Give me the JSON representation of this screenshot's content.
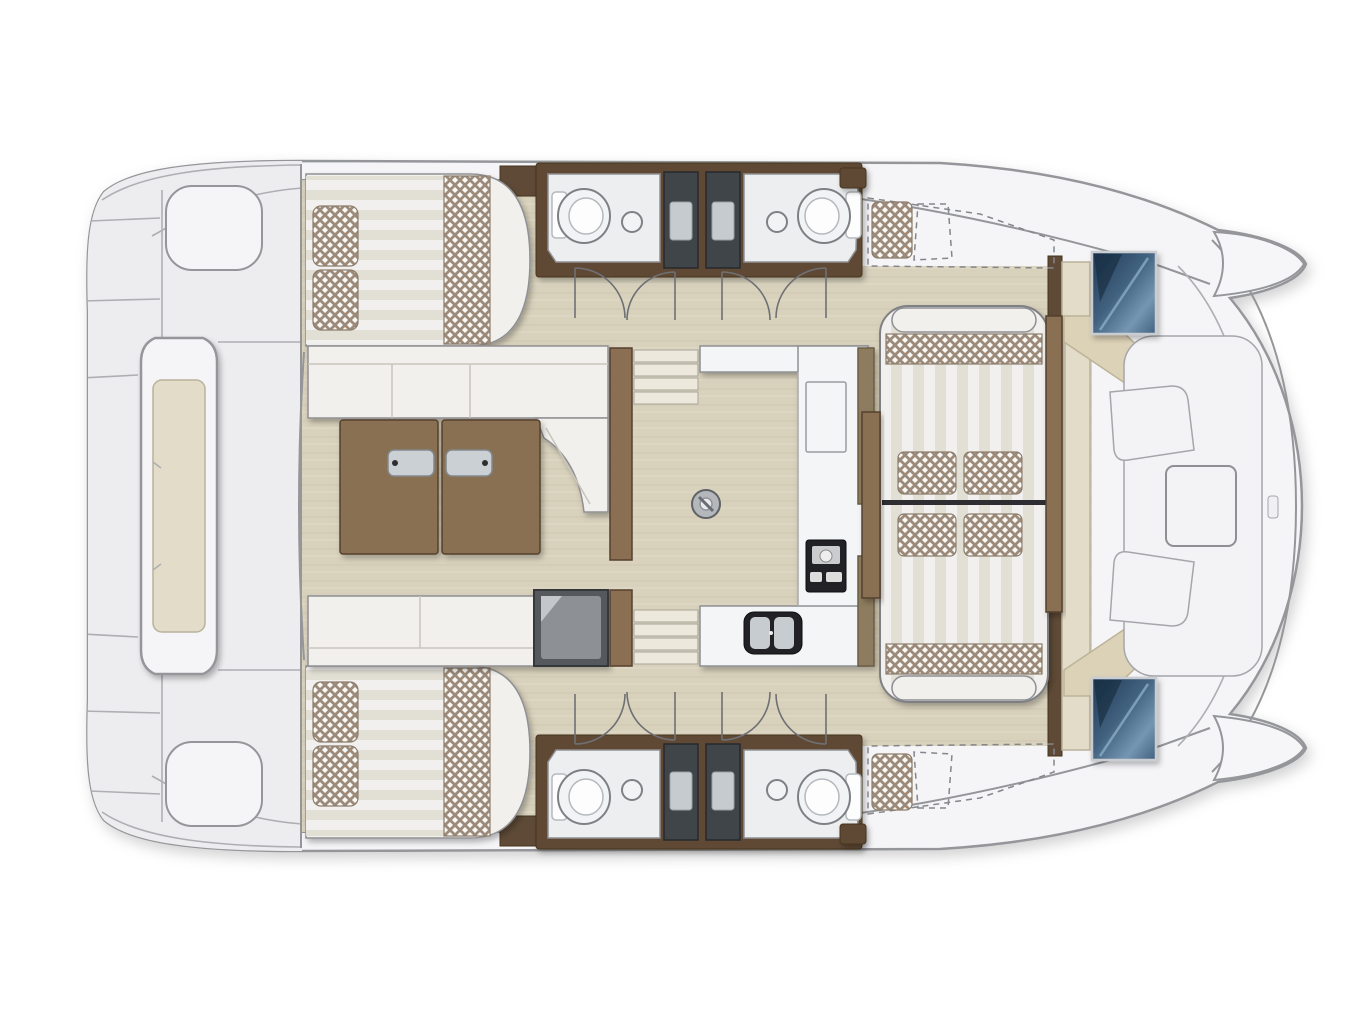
{
  "page": {
    "title": "Catamaran interior layout plan",
    "background": "#ffffff"
  },
  "plan": {
    "type": "catamaran-interior-floor-plan",
    "view": "top-down",
    "bow": "left",
    "stern": "right",
    "areas": [
      "foredeck-trampoline",
      "foredeck-lounge-pod",
      "port-forward-cabin",
      "port-heads-forward",
      "port-shower-stalls",
      "port-heads-aft",
      "starboard-forward-cabin",
      "starboard-heads-forward",
      "starboard-shower-stalls",
      "starboard-heads-aft",
      "saloon-l-sofa",
      "saloon-folding-table",
      "saloon-aft-sofa",
      "saloon-cabinet",
      "galley-counters",
      "galley-stove",
      "galley-sink",
      "companionway-steps-port",
      "companionway-steps-starboard",
      "mast-post",
      "cockpit-lounge",
      "cockpit-side-tables",
      "optional-helm-seat-port",
      "optional-helm-seat-starboard",
      "engine-hatch-port",
      "engine-hatch-starboard",
      "aft-bench",
      "stern-platforms"
    ],
    "fixture_counts": {
      "double_berths": 2,
      "toilets": 4,
      "washbasins": 4,
      "shower_stalls": 4,
      "berth_pillows": 4,
      "lounge_pillows": 4,
      "door_swings": 8,
      "engine_hatches": 2,
      "table_leaves": 2,
      "companionway_step_flights": 2
    }
  },
  "colors": {
    "page_bg": "#ffffff",
    "hull_outline": "#95969a",
    "deck_white": "#f5f5f7",
    "deck_line": "#aeafb3",
    "trampoline": "#ededef",
    "wood_floor": "#d8d1bc",
    "wood_grain": "#cdc5ae",
    "wood_grain_light": "#e2dcc8",
    "wood_brown": "#8a6f52",
    "wood_brown_dark": "#5e4a36",
    "cushion_white": "#f1f0ec",
    "cushion_seam": "#c8c5bb",
    "stripe_light": "#f1f0ee",
    "stripe_dark": "#e2dfd5",
    "hatch_bg": "#faf9f6",
    "hatch_line": "#9c8b7a",
    "shower_dark": "#3f4448",
    "shower_panel": "#c6cbd0",
    "counter_white": "#f4f5f7",
    "appliance_dark": "#232427",
    "metal": "#cbd0d4",
    "navy_dark": "#1f3a55",
    "navy_mid": "#41617f",
    "navy_light": "#7596b2",
    "cabinet_dark": "#55585c",
    "cabinet_mid": "#8d9196",
    "bench_tan": "#e3dcc9",
    "aft_tan": "#dcd2b8",
    "door_line": "#6f7074"
  }
}
